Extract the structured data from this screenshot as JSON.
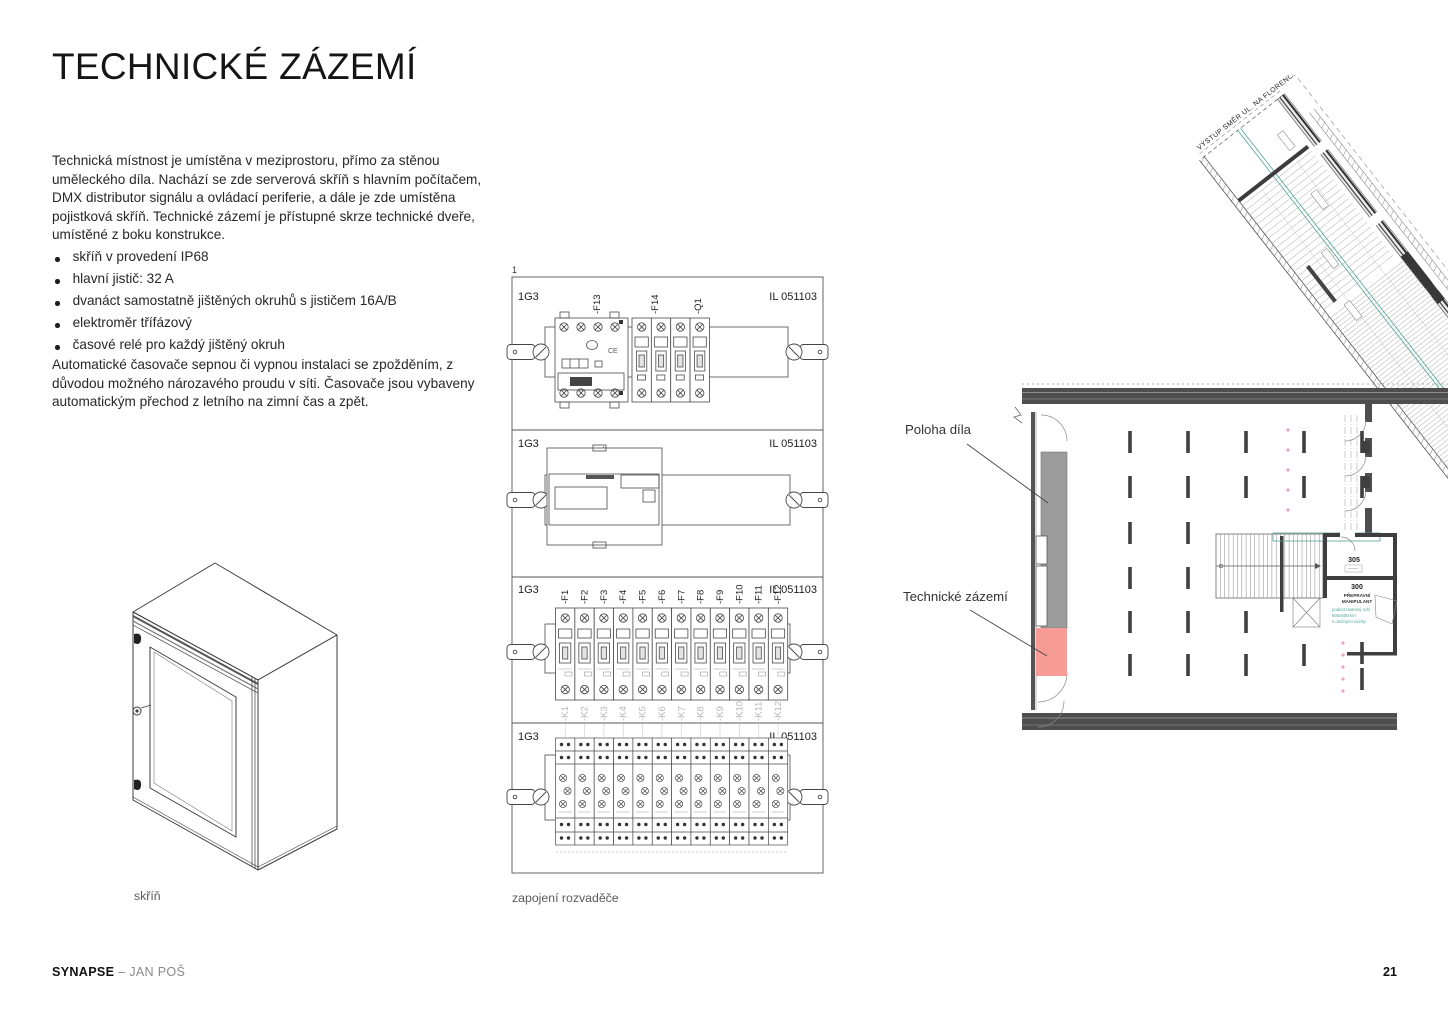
{
  "header": {
    "title": "TECHNICKÉ ZÁZEMÍ"
  },
  "content": {
    "intro": "Technická místnost je umístěna v meziprostoru, přímo za stěnou uměleckého díla. Nachází se zde serverová skříň s hlavním počítačem, DMX distributor signálu a ovládací periferie, a dále je zde umístěna pojistková skříň. Technické zázemí je přístupné skrze technické dveře, umístěné z boku konstrukce.",
    "bullets": [
      "skříň v provedení IP68",
      "hlavní jistič: 32 A",
      "dvanáct samostatně jištěných okruhů s jističem 16A/B",
      "elektroměr třífázový",
      "časové relé pro každý jištěný okruh"
    ],
    "automation_note": "Automatické časovače sepnou či vypnou instalaci se zpožděním, z důvodou možného nározavého proudu v síti. Časovače jsou vybaveny automatickým přechod z letního na zimní čas a zpět."
  },
  "cabinet_figure": {
    "caption": "skříň"
  },
  "wiring_figure": {
    "caption": "zapojení rozvaděče",
    "sheet_marker": "1",
    "panel_id": "1G3",
    "doc_id": "IL 051103",
    "ce_mark": "CE",
    "section1_components": [
      "-F13",
      "-F14",
      "-Q1"
    ],
    "section2_components": [
      "-P1"
    ],
    "breaker_labels": [
      "-F1",
      "-F2",
      "-F3",
      "-F4",
      "-F5",
      "-F6",
      "-F7",
      "-F8",
      "-F9",
      "-F10",
      "-F11",
      "-F12"
    ],
    "relay_labels": [
      "-K1",
      "-K2",
      "-K3",
      "-K4",
      "-K5",
      "-K6",
      "-K7",
      "-K8",
      "-K9",
      "-K10",
      "-K11",
      "-K12"
    ]
  },
  "floorplan_figure": {
    "artwork_label": "Poloha díla",
    "tech_label": "Technické zázemí",
    "corridor_label": "VÝSTUP SMĚR UL. NA FLORENCI",
    "rooms": {
      "r305": {
        "number": "305"
      },
      "r300": {
        "number": "300",
        "name_line1": "PŘEPRAVNÍ",
        "name_line2": "MANIPULANT",
        "note_lines": [
          "podest rastrový rošt",
          "600x600mm",
          "s otočnými vozíky"
        ]
      }
    },
    "colors": {
      "artwork_gray": "#9c9c9c",
      "tech_pink": "#f79b96",
      "teal": "#4fa396",
      "dot_pink": "#e7a6c9"
    }
  },
  "footer": {
    "brand": "SYNAPSE",
    "dash": "–",
    "author": "JAN POŠ",
    "page_number": "21"
  }
}
